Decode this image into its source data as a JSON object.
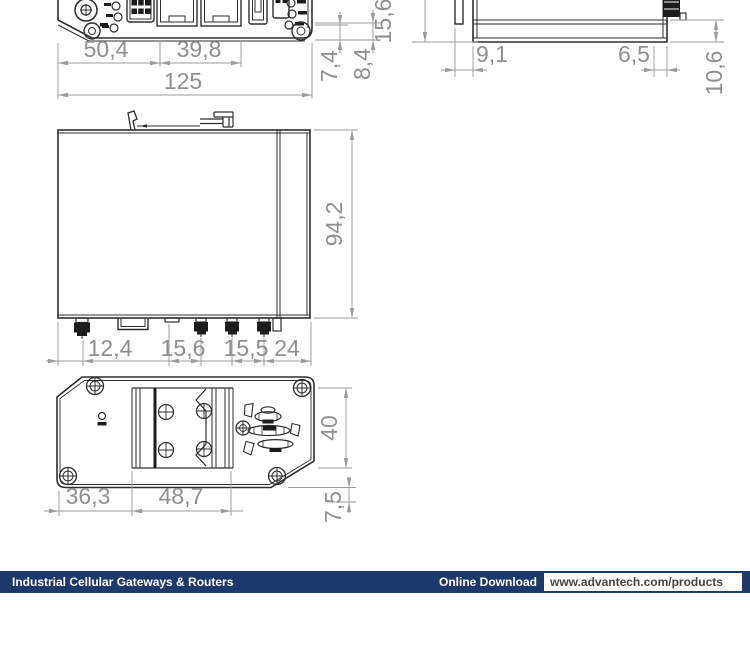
{
  "drawing": {
    "dims": {
      "front": {
        "eth_offset": "50,4",
        "eth_width": "39,8",
        "total_width": "125",
        "conn_h1": "7,4",
        "conn_h2": "8,4"
      },
      "side": {
        "body_height": "15,6",
        "tab_width": "9,1",
        "conn_offset": "6,5",
        "lip_height": "10,6"
      },
      "main": {
        "depth": "94,2",
        "conn1": "12,4",
        "conn2": "15,6",
        "conn3": "15,5",
        "conn4": "24"
      },
      "bottom": {
        "din_offset": "36,3",
        "din_width": "48,7",
        "din_height": "40",
        "clip_depth": "7,5"
      }
    }
  },
  "footer": {
    "title": "Industrial Cellular Gateways & Routers",
    "download_label": "Online Download",
    "url": "www.advantech.com/products"
  },
  "colors": {
    "outline": "#2e2e2e",
    "dimension_line": "#9b9b9b",
    "dimension_text": "#8f8f8f",
    "footer_navy": "#1c3a69",
    "url_text": "#444444"
  }
}
